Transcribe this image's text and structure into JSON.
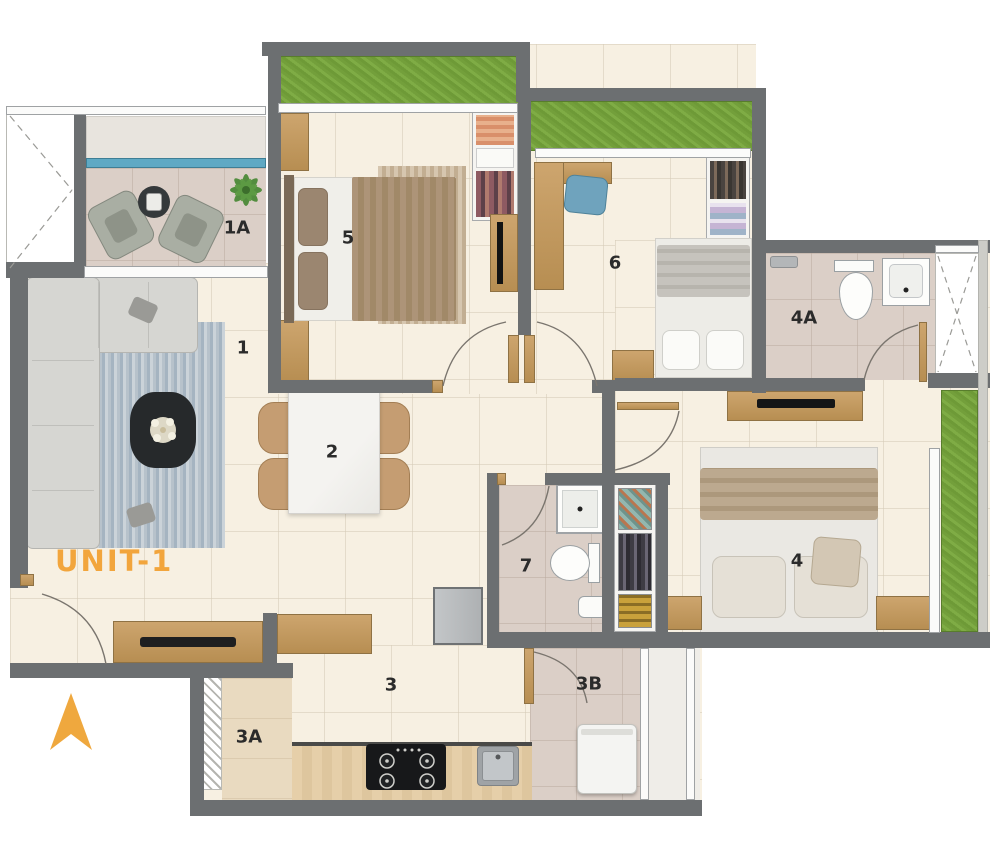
{
  "unit": {
    "label": "UNIT-1"
  },
  "rooms": [
    {
      "id": "living-room",
      "label": "1"
    },
    {
      "id": "balcony",
      "label": "1A"
    },
    {
      "id": "dining",
      "label": "2"
    },
    {
      "id": "kitchen",
      "label": "3"
    },
    {
      "id": "kitchen-ledge",
      "label": "3A"
    },
    {
      "id": "utility",
      "label": "3B"
    },
    {
      "id": "bedroom-4",
      "label": "4"
    },
    {
      "id": "bathroom-4a",
      "label": "4A"
    },
    {
      "id": "bedroom-5",
      "label": "5"
    },
    {
      "id": "bedroom-6",
      "label": "6"
    },
    {
      "id": "bathroom-7",
      "label": "7"
    }
  ],
  "colors": {
    "accent_orange": "#F2A53C",
    "wall_gray": "#6C6F71",
    "floor_cream": "#F7F0E2",
    "balcony_taupe": "#DBCFC7",
    "planter_green": "#7BA440",
    "glass_blue": "#5FA9C4",
    "wood": "#C69E63"
  }
}
